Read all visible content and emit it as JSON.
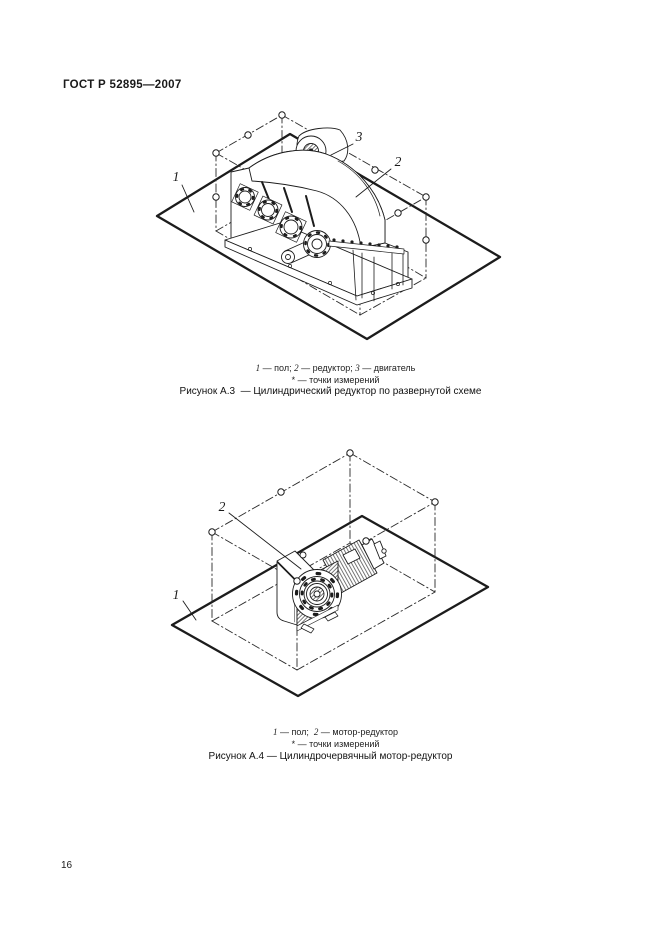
{
  "page": {
    "header": "ГОСТ Р 52895—2007",
    "page_number": "16"
  },
  "figure_a3": {
    "position_labels": {
      "floor": "1",
      "reducer": "2",
      "motor": "3"
    },
    "legend_parts": [
      {
        "num": "1",
        "text": " — пол; "
      },
      {
        "num": "2",
        "text": " — редуктор; "
      },
      {
        "num": "3",
        "text": " — двигатель"
      }
    ],
    "star": {
      "sym": "*",
      "text": " — точки измерений"
    },
    "caption": "Рисунок А.3  — Цилиндрический редуктор по развернутой схеме"
  },
  "figure_a4": {
    "position_labels": {
      "floor": "1",
      "motor_reducer": "2"
    },
    "legend_parts": [
      {
        "num": "1",
        "text": " — пол;  "
      },
      {
        "num": "2",
        "text": " — мотор-редуктор"
      }
    ],
    "star": {
      "sym": "*",
      "text": " — точки измерений"
    },
    "caption": "Рисунок А.4 — Цилиндрочервячный мотор-редуктор"
  }
}
